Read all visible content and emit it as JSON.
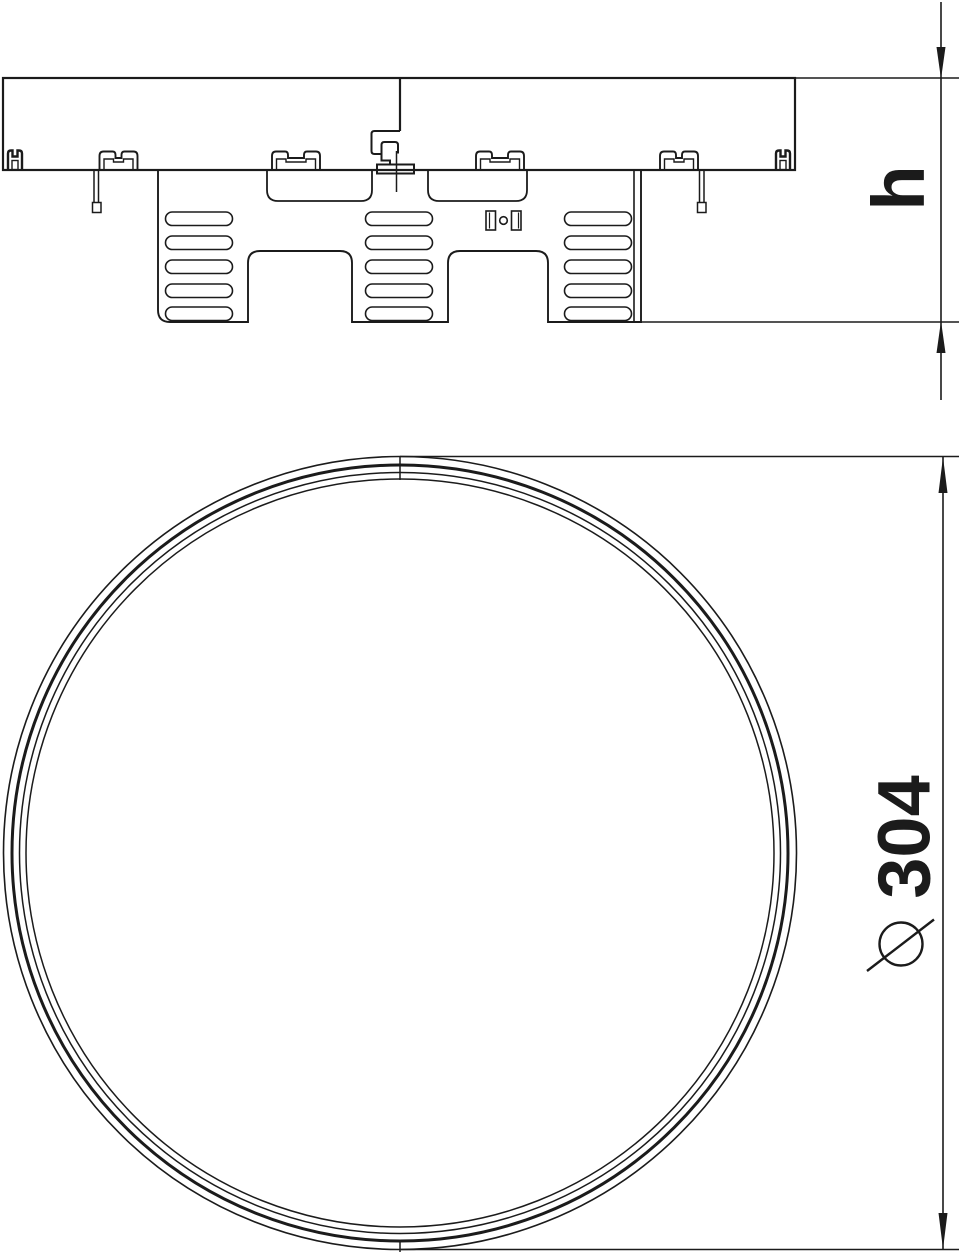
{
  "page": {
    "background": "#ffffff",
    "line_color": "#1b1b1b",
    "drawing_type": "technical-drawing"
  },
  "dimensions": {
    "height": {
      "label": "h"
    },
    "diameter": {
      "label": "⌀ 304",
      "symbol": "⌀",
      "value": "304"
    }
  }
}
